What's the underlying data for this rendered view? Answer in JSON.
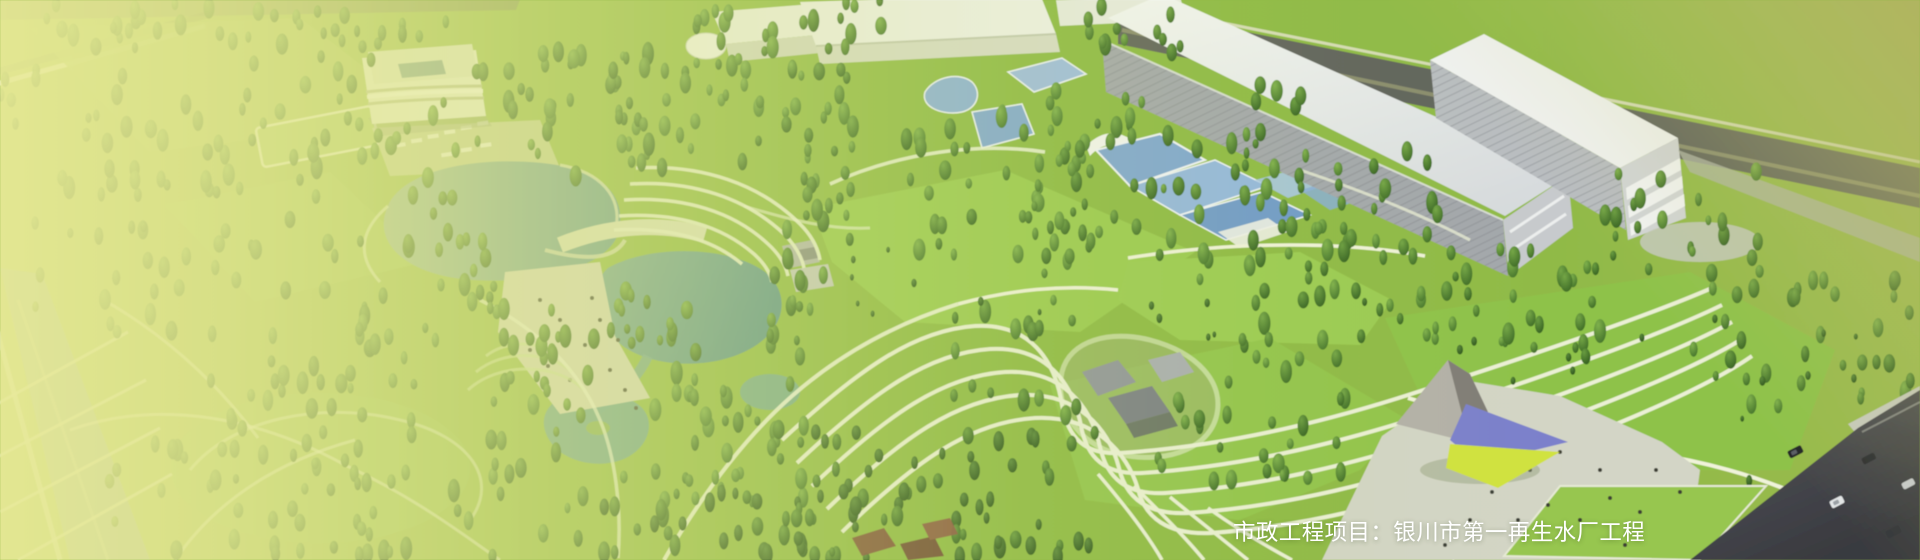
{
  "banner": {
    "caption": "市政工程项目：银川市第一再生水厂工程",
    "caption_color": "#ffffff"
  },
  "scene": {
    "type": "aerial-architectural-rendering",
    "colors": {
      "grass": "#8fb944",
      "wash_left": "#e2e493",
      "wash_top_right": "#b8b36a",
      "lake_teal": "#6aa294",
      "tree_green": "#4e7d32",
      "building_roof": "#eff1ec",
      "building_face": "#b0b4b9",
      "road_dark": "#45464c",
      "plaza": "#d3d5c6",
      "pool_blue": "#8fb3d9",
      "canopy_purple": "#7b80cc",
      "canopy_yellow": "#d0e23f",
      "path_white": "#f0f3da"
    }
  }
}
